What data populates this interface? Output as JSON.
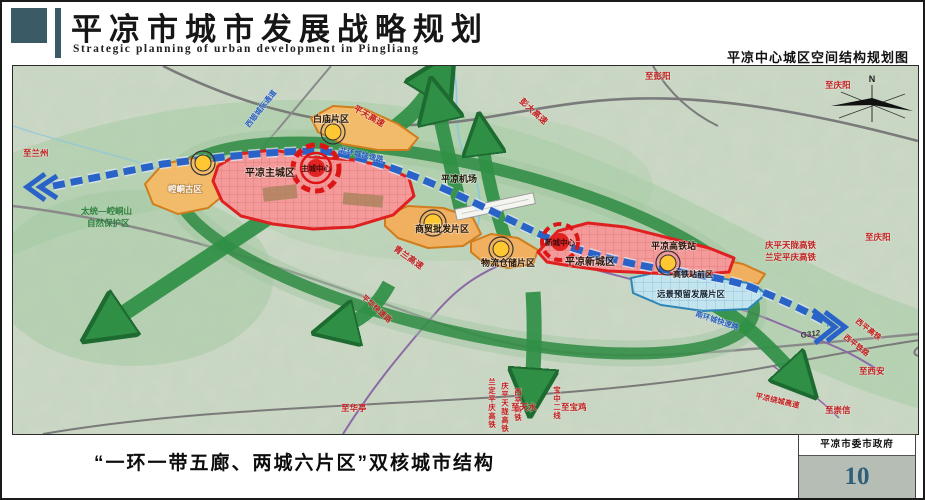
{
  "header": {
    "title": "平凉市城市发展战略规划",
    "subtitle": "Strategic planning of urban development in Pingliang",
    "right_caption": "平凉中心城区空间结构规划图"
  },
  "footer": {
    "caption": "“一环一带五廊、两城六片区”双核城市结构",
    "authority": "平凉市委市政府",
    "page_number": "10"
  },
  "map": {
    "compass": "N",
    "labels": {
      "to_lanzhou": "至兰州",
      "xiyin_corridor": "西银城际通道",
      "baimiao_district": "白庙片区",
      "pingtian_expwy": "平天高速",
      "pengda_expwy": "彭大高速",
      "to_pengyang": "至彭阳",
      "to_qingyang_top": "至庆阳",
      "north_ring_road": "北环城快速路",
      "airport": "平凉机场",
      "kongtong_old_town": "崆峒古区",
      "main_city": "平凉主城区",
      "main_city_center": "主城中心",
      "nature_reserve_line1": "太统—崆峒山",
      "nature_reserve_line2": "自然保护区",
      "qinglan_expwy": "青兰高速",
      "trade_district": "商贸批发片区",
      "logistics_district": "物流仓储片区",
      "new_city": "平凉新城区",
      "new_city_center": "新城中心",
      "hsr_station": "平凉高铁站",
      "qptl_hsr": "庆平天陇高铁",
      "ldpq_hsr": "兰定平庆高铁",
      "to_qingyang_right": "至庆阳",
      "hsr_front_district": "高铁站前区",
      "reserved_district": "远景预留发展片区",
      "south_ring_road": "南环城快速路",
      "g312": "G312",
      "xiping_hsr": "西平高铁",
      "xiping_railway": "西平铁路",
      "to_xian": "至西安",
      "raocheng_expwy": "平凉绕城高速",
      "to_chongxin": "至崇信",
      "to_huating": "至华亭",
      "pinghua_expwy": "平华快速路",
      "v_ldpq": "兰定平庆高铁",
      "v_qptl": "庆平天陇高铁",
      "v_xiping": "西平高铁",
      "v_baozhong": "宝中二线",
      "to_tianshui": "至天水",
      "to_baoji": "至宝鸡"
    },
    "colors": {
      "header_accent": "#3a5a66",
      "corridor_green": "#2f8f45",
      "belt_blue": "#2a63c8",
      "city_red": "#e02020",
      "district_orange": "#e8941f",
      "reserve_blue": "#2e86b8",
      "page_number_blue": "#2e5f7a"
    }
  }
}
